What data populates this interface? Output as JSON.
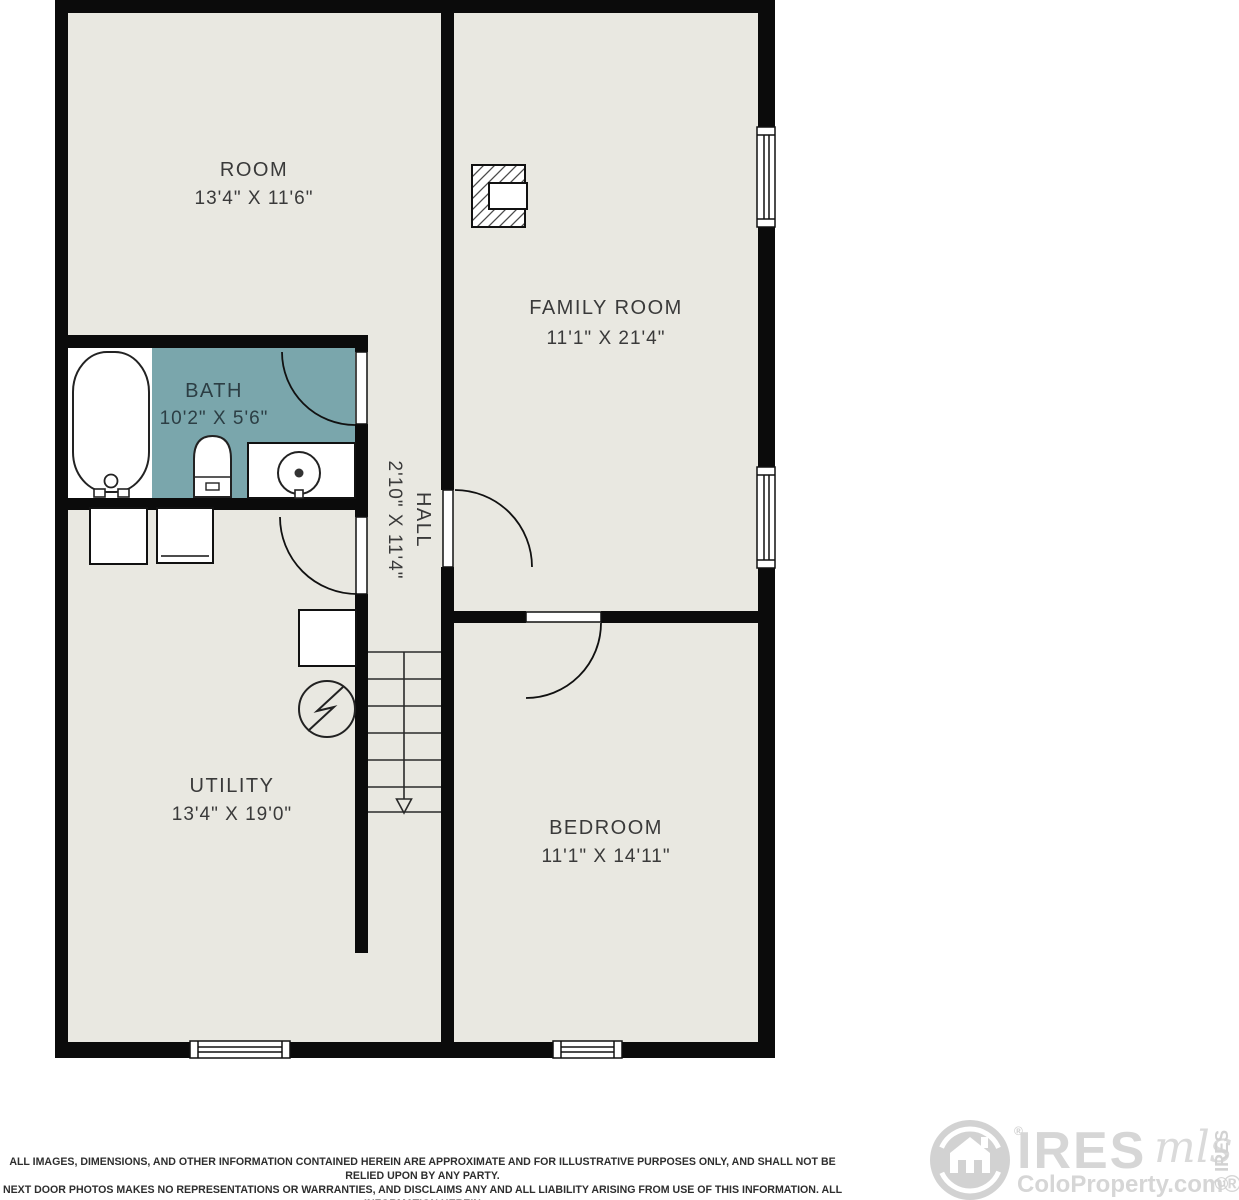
{
  "floorplan": {
    "rooms": [
      {
        "name": "ROOM",
        "dims": "13'4\" X 11'6\""
      },
      {
        "name": "FAMILY ROOM",
        "dims": "11'1\" X 21'4\""
      },
      {
        "name": "BATH",
        "dims": "10'2\" X 5'6\""
      },
      {
        "name": "HALL",
        "dims": "2'10\" X 11'4\""
      },
      {
        "name": "UTILITY",
        "dims": "13'4\" X 19'0\""
      },
      {
        "name": "BEDROOM",
        "dims": "11'1\" X 14'11\""
      }
    ],
    "icons": [
      "fireplace",
      "window",
      "door",
      "stairs-down",
      "bathtub",
      "toilet",
      "sink-vanity",
      "washer",
      "dryer",
      "furnace",
      "electrical-panel"
    ],
    "colors": {
      "wall": "#0b0b0b",
      "floor": "#e9e8e1",
      "bath_floor": "#7aa6ac",
      "fixture_fill": "#ffffff",
      "label": "#3a3a3a",
      "bath_label": "#2c3e44",
      "logo_gray": "#d4d4d4"
    }
  },
  "footer": {
    "disclaimer": [
      "ALL IMAGES, DIMENSIONS, AND OTHER INFORMATION CONTAINED HEREIN ARE APPROXIMATE AND FOR ILLUSTRATIVE PURPOSES ONLY, AND SHALL NOT BE RELIED UPON BY ANY PARTY.",
      "NEXT DOOR PHOTOS MAKES NO REPRESENTATIONS OR WARRANTIES, AND DISCLAIMS ANY AND ALL LIABILITY ARISING FROM USE OF THIS INFORMATION. ALL INFORMATION HEREIN",
      "SHALL BE SUBJECT TO THE TERMS AND CONDITIONS FOUND AT NEXTDOORPHOTOS.COM/TC."
    ]
  },
  "branding": {
    "ires": "IRES",
    "mls": "mls",
    "registered": "®",
    "coloproperty": "ColoProperty.com®",
    "copyright": "© IRES"
  }
}
